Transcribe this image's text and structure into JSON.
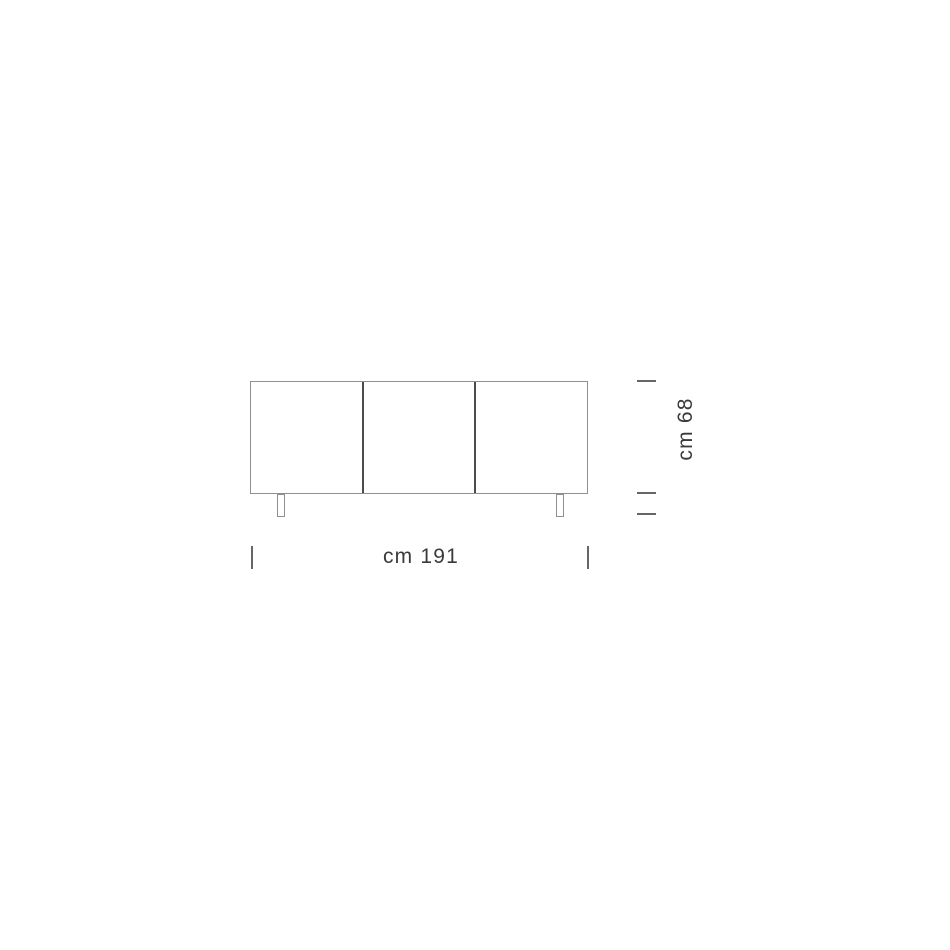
{
  "diagram": {
    "type": "furniture-dimension-drawing",
    "product": "three-door sideboard front elevation",
    "door_count": 3,
    "width_label": "cm 191",
    "height_label": "cm 68"
  },
  "colors": {
    "background": "#ffffff",
    "outline": "#909090",
    "divider": "#4c4c4c",
    "tick": "#666666",
    "text": "#3a3a3a"
  }
}
